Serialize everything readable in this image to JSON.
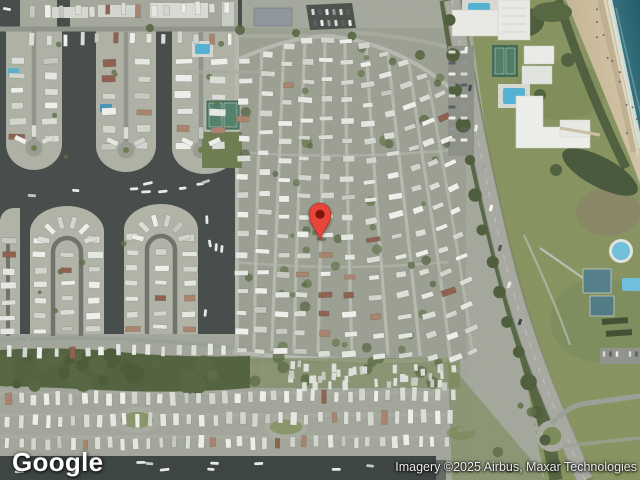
{
  "app": {
    "name": "Google Maps satellite view",
    "view_type": "satellite imagery"
  },
  "watermark": {
    "logo_text": "Google"
  },
  "attribution": {
    "text": "Imagery ©2025 Airbus, Maxar Technologies"
  },
  "pin": {
    "icon": "red-teardrop-marker",
    "x": 320,
    "y": 239,
    "color": "#E8453A",
    "border": "#B93025",
    "dot": "#7E150D"
  },
  "palette": {
    "water": "#454b49",
    "canal": "#3b4340",
    "ocean_deep": "#1e5a68",
    "ocean_light": "#4a8690",
    "surf": "#dfe8e0",
    "beach": "#cfc2a2",
    "land": "#a4a89b",
    "park": "#9b9f91",
    "street": "#b6b9ae",
    "asphalt": "#90938a",
    "highway": "#a7a9a1",
    "home": "#e6e8e3",
    "tree": "#4e5e3b",
    "lawn": "#86935f",
    "pool": "#53b2d3",
    "parking": "#4c504b",
    "sand_wet": "#b3a284",
    "court": "#527e89"
  }
}
